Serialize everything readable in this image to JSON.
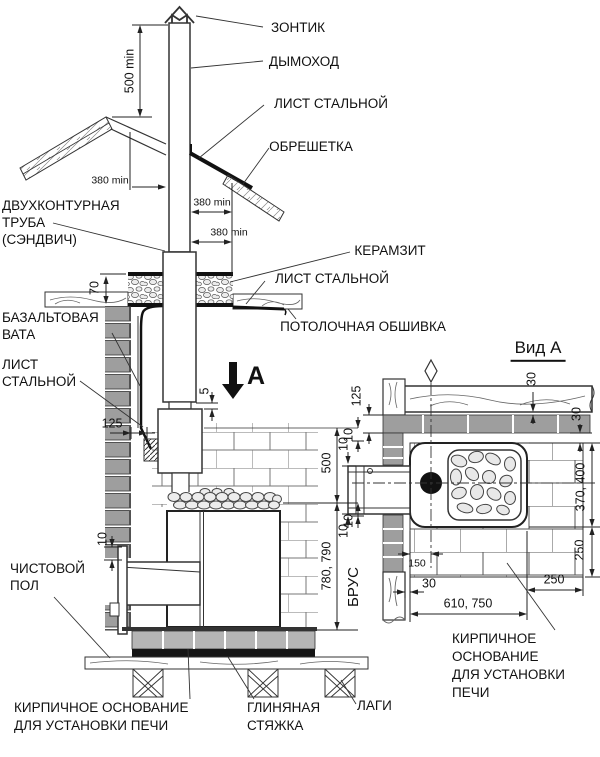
{
  "drawing": {
    "callouts": {
      "zontik": "ЗОНТИК",
      "dymohod": "ДЫМОХОД",
      "list_roof": "ЛИСТ СТАЛЬНОЙ",
      "obreshetka": "ОБРЕШЕТКА",
      "sandwich1": "ДВУХКОНТУРНАЯ",
      "sandwich2": "ТРУБА",
      "sandwich3": "(СЭНДВИЧ)",
      "keramzit": "КЕРАМЗИТ",
      "list_ceiling": "ЛИСТ СТАЛЬНОЙ",
      "potolok": "ПОТОЛОЧНАЯ ОБШИВКА",
      "bazalt1": "БАЗАЛЬТОВАЯ",
      "bazalt2": "ВАТА",
      "list_wall1": "ЛИСТ",
      "list_wall2": "СТАЛЬНОЙ",
      "chist1": "ЧИСТОВОЙ",
      "chist2": "ПОЛ",
      "osn_left1": "КИРПИЧНОЕ ОСНОВАНИЕ",
      "osn_left2": "ДЛЯ УСТАНОВКИ ПЕЧИ",
      "glina1": "ГЛИНЯНАЯ",
      "glina2": "СТЯЖКА",
      "lagi": "ЛАГИ",
      "vid_a": "Вид А",
      "view_arrow": "А",
      "brus": "БРУС",
      "osn_right1": "КИРПИЧНОЕ",
      "osn_right2": "ОСНОВАНИЕ",
      "osn_right3": "ДЛЯ УСТАНОВКИ",
      "osn_right4": "ПЕЧИ"
    },
    "dims": {
      "d500min": "500 min",
      "d380a": "380 min",
      "d380b": "380 min",
      "d380c": "380 min",
      "d70": "70",
      "d125_elev": "125",
      "d5": "5",
      "d10_door": "10",
      "d500": "500",
      "d10_a": "10",
      "d780": "780, 790",
      "d10_b": "10",
      "d125_view": "125",
      "d30_top": "30",
      "d30_right": "30",
      "d370": "370, 400",
      "d250_right": "250",
      "d10_c": "10",
      "d10_d": "10",
      "d150": "150",
      "d30_bottom": "30",
      "d610": "610, 750",
      "d250_bottom": "250"
    }
  }
}
